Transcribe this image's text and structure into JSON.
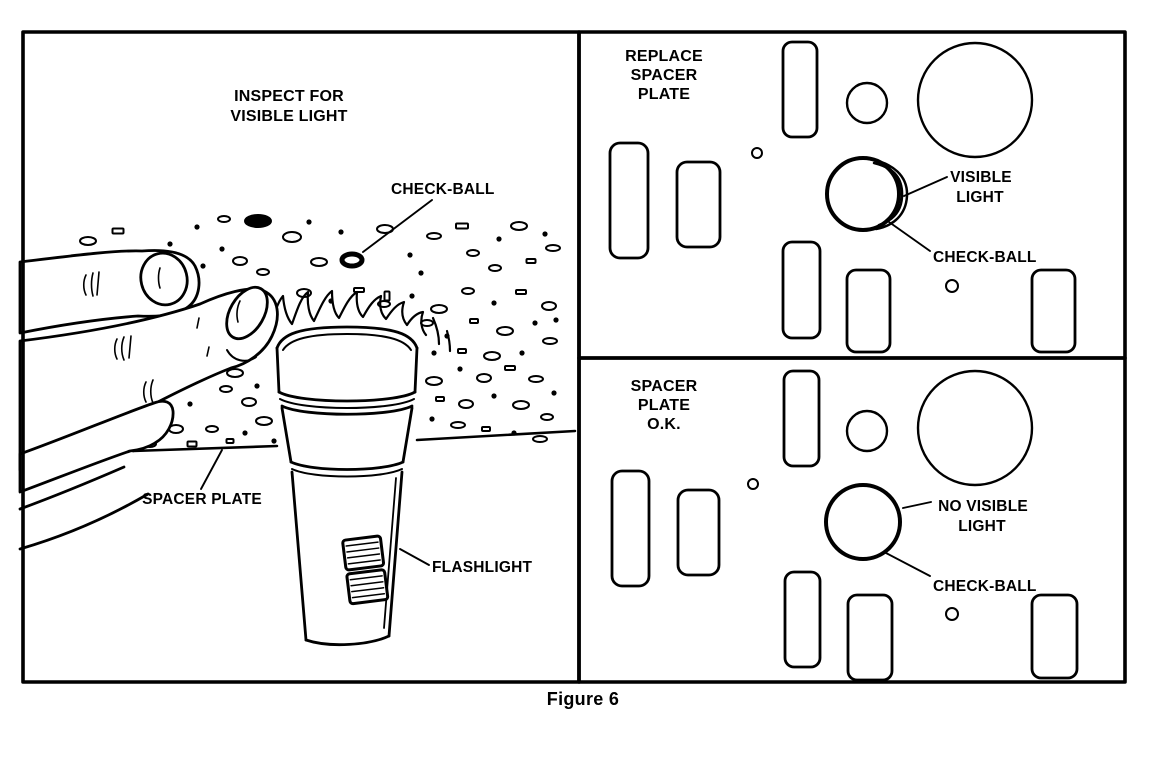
{
  "figure": {
    "caption": "Figure 6"
  },
  "panel_inspect": {
    "title": [
      "INSPECT FOR",
      "VISIBLE LIGHT"
    ],
    "label_check_ball": "CHECK-BALL",
    "label_spacer_plate": "SPACER PLATE",
    "label_flashlight": "FLASHLIGHT"
  },
  "panel_replace": {
    "title": [
      "REPLACE",
      "SPACER",
      "PLATE"
    ],
    "label_visible_light": [
      "VISIBLE",
      "LIGHT"
    ],
    "label_check_ball": "CHECK-BALL"
  },
  "panel_ok": {
    "title": [
      "SPACER",
      "PLATE",
      "O.K."
    ],
    "label_no_visible_light": [
      "NO VISIBLE",
      "LIGHT"
    ],
    "label_check_ball": "CHECK-BALL"
  },
  "colors": {
    "ink": "#000000",
    "paper": "#ffffff"
  }
}
